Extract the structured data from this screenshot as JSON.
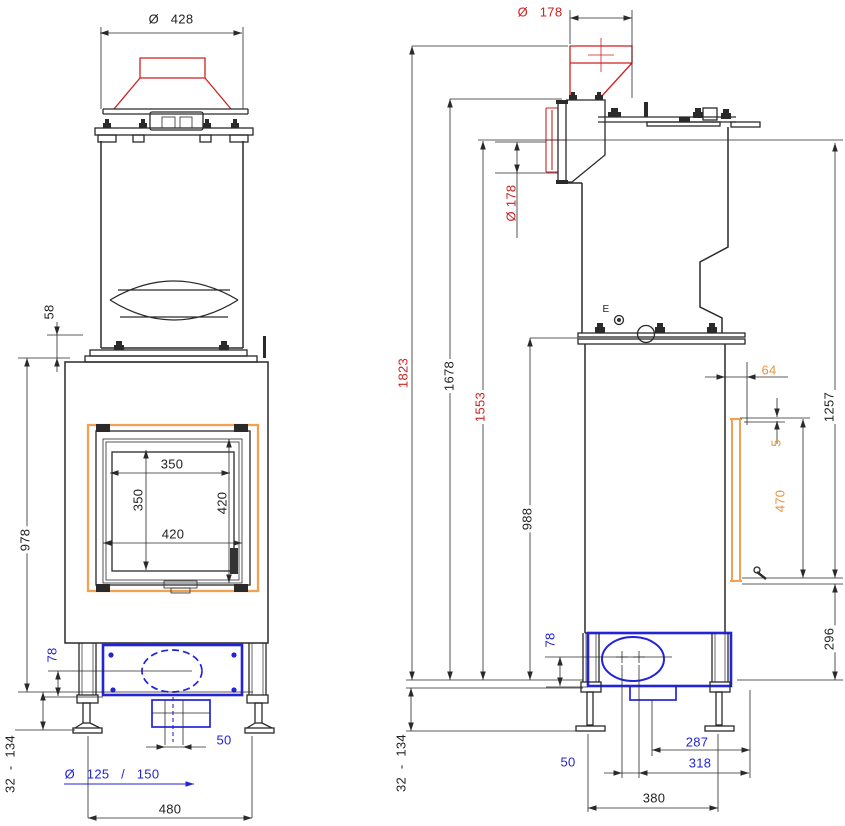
{
  "front_view": {
    "labels": {
      "flue_diameter": "Ø   428",
      "collar_height": "58",
      "body_height": "978",
      "glass_width": "350",
      "glass_height": "350",
      "door_width": "420",
      "door_height": "420",
      "plinth_height": "78",
      "leg_range": "32  -  134",
      "bottom_offset": "50",
      "bottom_flue_diameter": "Ø   125   /   150",
      "feet_spacing": "480"
    }
  },
  "side_view": {
    "labels": {
      "top_flue_diameter": "Ø   178",
      "rear_flue_diameter": "Ø 178",
      "total_height": "1823",
      "height_to_top_plate": "1678",
      "height_to_rear_flue": "1553",
      "height_to_body_top": "988",
      "plinth_height": "78",
      "leg_range": "32  -  134",
      "marker_e": "E",
      "door_offset": "64",
      "door_gap": "5",
      "rear_door_height": "470",
      "flue_to_door_bottom": "1257",
      "door_bottom_height": "296",
      "stub_to_rear": "287",
      "center_offset": "50",
      "center_to_rear": "318",
      "feet_spacing": "380"
    }
  },
  "colors": {
    "dimension_red": "#cc2222",
    "dimension_blue": "#2323d8",
    "dimension_orange": "#e8953a",
    "door_frame_orange": "#f0a152",
    "line_black": "#2a2a2a"
  }
}
